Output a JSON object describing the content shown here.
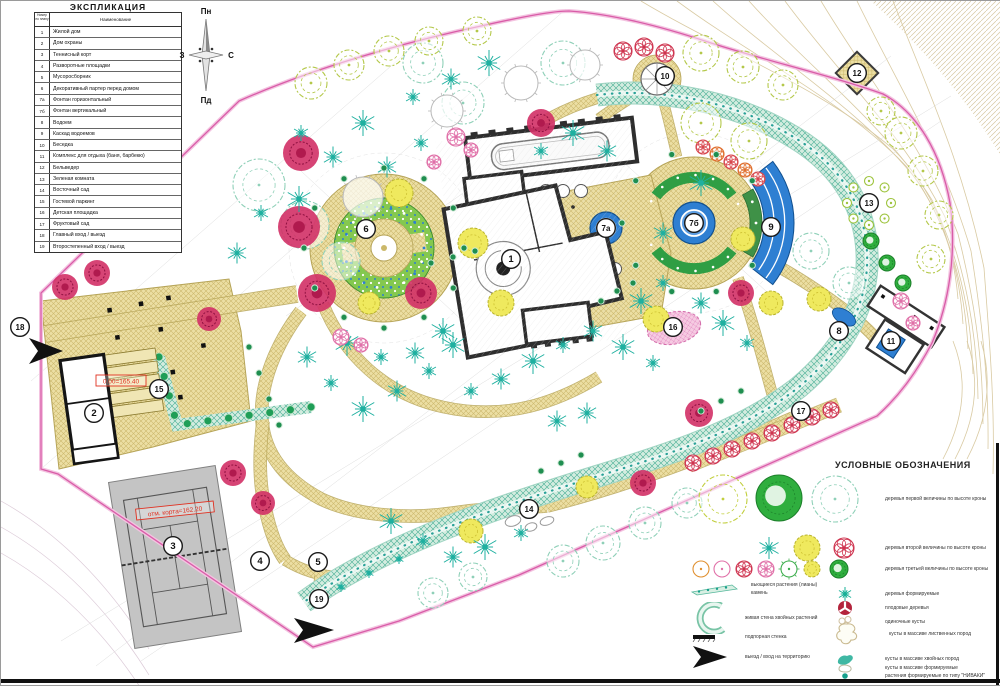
{
  "title_block": {
    "explication_title": "ЭКСПЛИКАЦИЯ",
    "col_num": "Номер по плану",
    "col_name": "Наименование",
    "rows": [
      {
        "num": "1",
        "name": "Жилой дом"
      },
      {
        "num": "2",
        "name": "Дом охраны"
      },
      {
        "num": "3",
        "name": "Теннисный корт"
      },
      {
        "num": "4",
        "name": "Разворотные площадки"
      },
      {
        "num": "5",
        "name": "Мусоросборник"
      },
      {
        "num": "6",
        "name": "Декоративный партер перед домом"
      },
      {
        "num": "7а",
        "name": "Фонтан горизонтальный"
      },
      {
        "num": "7б",
        "name": "Фонтан вертикальный"
      },
      {
        "num": "8",
        "name": "Водоем"
      },
      {
        "num": "9",
        "name": "Каскад водоемов"
      },
      {
        "num": "10",
        "name": "Беседка"
      },
      {
        "num": "11",
        "name": "Комплекс для отдыха (баня, барбекю)"
      },
      {
        "num": "12",
        "name": "Бельведер"
      },
      {
        "num": "13",
        "name": "Зеленая комната"
      },
      {
        "num": "14",
        "name": "Восточный сад"
      },
      {
        "num": "15",
        "name": "Гостевой паркинг"
      },
      {
        "num": "16",
        "name": "Детская площадка"
      },
      {
        "num": "17",
        "name": "Фруктовый сад"
      },
      {
        "num": "18",
        "name": "Главный вход / выезд"
      },
      {
        "num": "19",
        "name": "Второстепенный вход / выезд"
      }
    ]
  },
  "compass": {
    "north": "Пн",
    "south": "Пд",
    "west": "З",
    "east": "С"
  },
  "legend": {
    "title": "УСЛОВНЫЕ ОБОЗНАЧЕНИЯ",
    "size_rows": [
      {
        "symbol": "trees-size-1",
        "label": "деревья первой величины по высоте кроны"
      },
      {
        "symbol": "trees-size-2",
        "label": "деревья второй величины по высоте кроны"
      },
      {
        "symbol": "trees-size-3",
        "label": "деревья третьей величины по высоте кроны"
      }
    ],
    "right_items": [
      {
        "symbol": "tree-formed",
        "label": "деревья формируемые"
      },
      {
        "symbol": "fruit-tree",
        "label": "плодовые деревья"
      },
      {
        "symbol": "single-shrub",
        "label": "одиночные кусты"
      },
      {
        "symbol": "shrub-mass-deciduous",
        "label": "кусты в массиве лиственных пород"
      },
      {
        "symbol": "shrub-mass-conifer",
        "label": "кусты в массиве хвойных пород"
      },
      {
        "symbol": "shrub-mass-formed",
        "label": "кусты в массиве формируемые"
      },
      {
        "symbol": "niwaki",
        "label": "растения формируемые по типу \"НИВАКИ\""
      }
    ],
    "left_items": [
      {
        "symbol": "vines-strip",
        "label": "вьющиеся растения (лианы)",
        "label2": "камень"
      },
      {
        "symbol": "conifer-wall",
        "label": "живая стена хвойных растений"
      },
      {
        "symbol": "retaining-wall",
        "label": "подпорная стенка"
      },
      {
        "symbol": "entry-arrow",
        "label": "выезд / вход на территорию"
      }
    ]
  },
  "plan": {
    "markers": [
      {
        "id": "1",
        "x": 510,
        "y": 258
      },
      {
        "id": "2",
        "x": 93,
        "y": 412
      },
      {
        "id": "3",
        "x": 172,
        "y": 545
      },
      {
        "id": "4",
        "x": 259,
        "y": 560
      },
      {
        "id": "5",
        "x": 317,
        "y": 561
      },
      {
        "id": "6",
        "x": 365,
        "y": 228
      },
      {
        "id": "7а",
        "x": 605,
        "y": 227
      },
      {
        "id": "7б",
        "x": 693,
        "y": 222
      },
      {
        "id": "8",
        "x": 838,
        "y": 330
      },
      {
        "id": "9",
        "x": 770,
        "y": 226
      },
      {
        "id": "10",
        "x": 664,
        "y": 75
      },
      {
        "id": "11",
        "x": 890,
        "y": 340
      },
      {
        "id": "12",
        "x": 856,
        "y": 72
      },
      {
        "id": "13",
        "x": 868,
        "y": 202
      },
      {
        "id": "14",
        "x": 528,
        "y": 508
      },
      {
        "id": "15",
        "x": 158,
        "y": 388
      },
      {
        "id": "16",
        "x": 672,
        "y": 326
      },
      {
        "id": "17",
        "x": 800,
        "y": 410
      },
      {
        "id": "18",
        "x": 19,
        "y": 326
      },
      {
        "id": "19",
        "x": 318,
        "y": 598
      }
    ],
    "annotations": [
      {
        "text": "0.00=165.40",
        "x": 120,
        "y": 380,
        "rot": 0,
        "w": 50
      },
      {
        "text": "отм. корта=162.20",
        "x": 174,
        "y": 510,
        "rot": -6,
        "w": 78
      }
    ],
    "colors": {
      "boundary": "#d95ca8",
      "band": "#2aa198",
      "path": "#ecdfa4",
      "water": "#2e7fd2"
    }
  }
}
